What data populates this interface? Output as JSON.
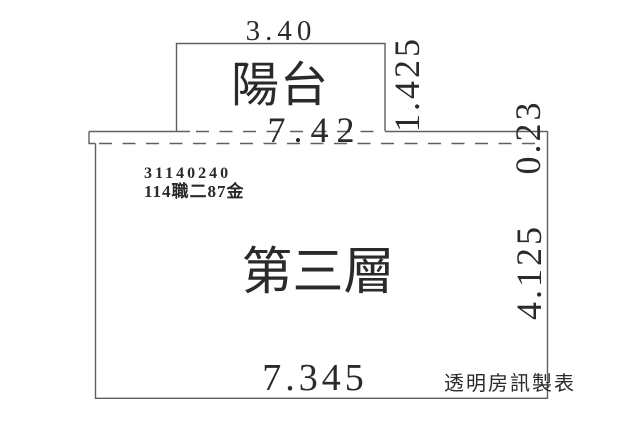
{
  "plan": {
    "balcony": {
      "label": "陽台",
      "width_dim": "3.40",
      "depth_dim": "1.425"
    },
    "main_floor": {
      "label": "第三層",
      "parcel_number": "31140240",
      "registration_note": "114職二87金",
      "top_width_dim": "7.42",
      "strip_depth_dim": "0.23",
      "depth_dim": "4.125",
      "width_dim": "7.345"
    },
    "watermark": "透明房訊製表"
  },
  "colors": {
    "line": "#606060",
    "text": "#2a2a2a",
    "background": "#ffffff"
  }
}
